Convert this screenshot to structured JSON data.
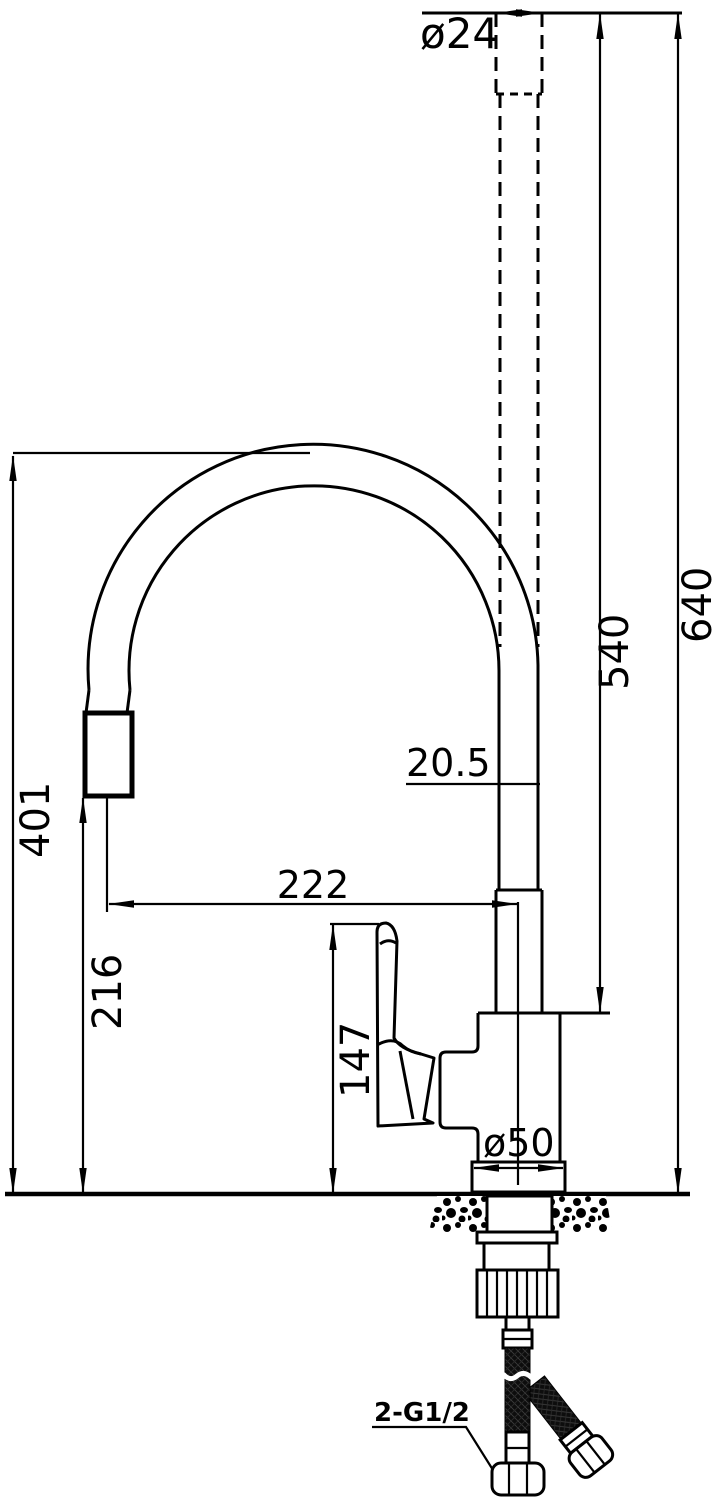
{
  "drawing": {
    "type": "technical-dimension-drawing",
    "subject": "pull-down kitchen faucet side elevation",
    "background_color": "#ffffff",
    "line_color": "#000000",
    "labels": {
      "spout_top_diameter": "ø24",
      "overall_height": "640",
      "height_to_body_top": "540",
      "hose_loop_height": "401",
      "spray_outlet_height": "216",
      "spout_reach": "222",
      "spout_tube_diameter": "20.5",
      "handle_top_height": "147",
      "base_flange_diameter": "ø50",
      "supply_hose_thread": "2-G1/2"
    }
  }
}
